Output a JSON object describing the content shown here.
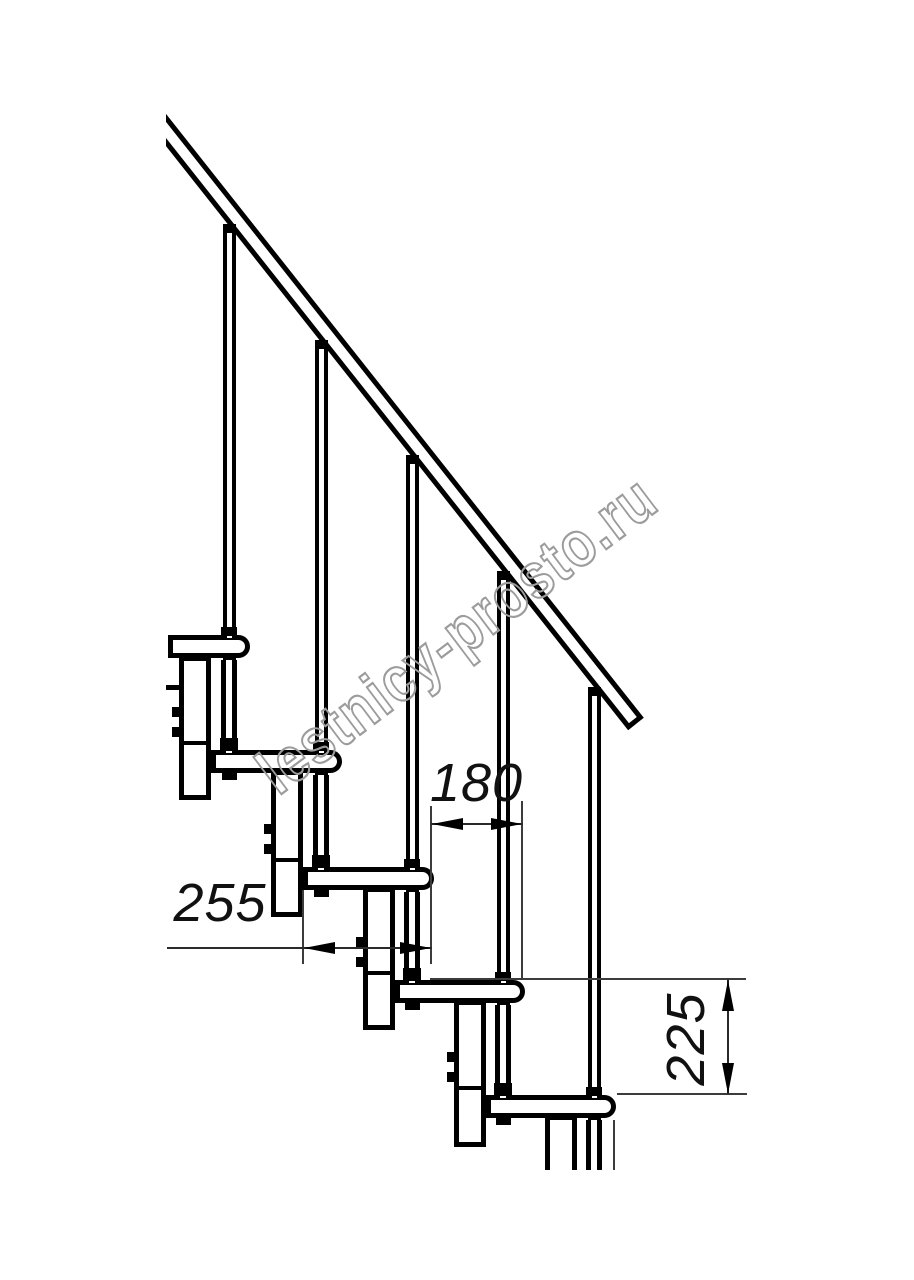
{
  "page": {
    "type": "technical-drawing",
    "background": "#ffffff",
    "line_color": "#000000",
    "subject": "modular staircase side view fragment: handrail, five treads, balusters, nose posts and spine column modules"
  },
  "watermark": {
    "text": "lestnicy-prosto.ru",
    "color": "#9c9c9c"
  },
  "dimensions": {
    "run": {
      "value": "180",
      "orientation": "horizontal"
    },
    "depth": {
      "value": "255",
      "orientation": "horizontal"
    },
    "rise": {
      "value": "225",
      "orientation": "vertical"
    }
  },
  "drawing": {
    "treads_visible": 5,
    "balusters_visible": 5,
    "column_modules_visible": 5,
    "handrail": true
  }
}
